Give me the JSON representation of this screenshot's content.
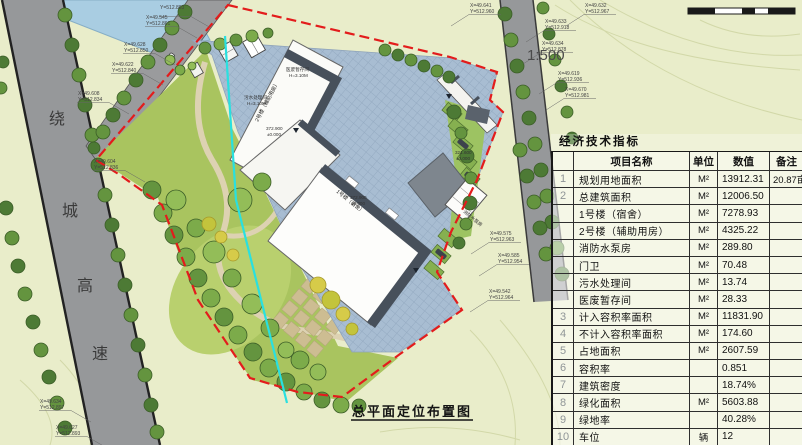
{
  "meta": {
    "scale_label": "1:500",
    "drawing_title": "总平面定位布置图"
  },
  "highway": [
    "绕",
    "城",
    "高",
    "速"
  ],
  "plan_labels": {
    "bld1_name": "1号楼（宿舍）",
    "bld2_name": "2号楼（辅助用房）",
    "sewage_room": "污水处理间",
    "sewage_h": "H=3.10M",
    "medical_room": "医废暂存间",
    "medical_h": "H=3.10M",
    "pump_room": "消防水泵房",
    "pump_elev": "321.600",
    "pump_zero": "±0.000",
    "elev": "372.900",
    "elev_zero": "±0.000"
  },
  "coordinates": [
    {
      "x": 470,
      "y": 2,
      "l1": "X=49.641",
      "l2": "Y=512.960",
      "side": "R"
    },
    {
      "x": 160,
      "y": 4,
      "l1": "Y=512.883",
      "l2": "",
      "side": "L"
    },
    {
      "x": 146,
      "y": 14,
      "l1": "X=49.545",
      "l2": "Y=512.861",
      "side": "L"
    },
    {
      "x": 124,
      "y": 41,
      "l1": "X=49.628",
      "l2": "Y=512.850",
      "side": "L"
    },
    {
      "x": 112,
      "y": 61,
      "l1": "X=49.622",
      "l2": "Y=512.840",
      "side": "L"
    },
    {
      "x": 78,
      "y": 90,
      "l1": "X=49.608",
      "l2": "Y=512.834",
      "side": "L"
    },
    {
      "x": 94,
      "y": 158,
      "l1": "X=49.604",
      "l2": "Y=512.836",
      "side": "L"
    },
    {
      "x": 585,
      "y": 2,
      "l1": "X=49.632",
      "l2": "Y=512.967",
      "side": "R"
    },
    {
      "x": 545,
      "y": 18,
      "l1": "X=49.633",
      "l2": "Y=512.918",
      "side": "R"
    },
    {
      "x": 542,
      "y": 40,
      "l1": "X=49.634",
      "l2": "Y=512.878",
      "side": "R"
    },
    {
      "x": 558,
      "y": 70,
      "l1": "X=49.619",
      "l2": "Y=512.936",
      "side": "R"
    },
    {
      "x": 565,
      "y": 86,
      "l1": "X=49.670",
      "l2": "Y=512.981",
      "side": "R"
    },
    {
      "x": 490,
      "y": 230,
      "l1": "X=49.575",
      "l2": "Y=512.963",
      "side": "R"
    },
    {
      "x": 498,
      "y": 252,
      "l1": "X=49.585",
      "l2": "Y=512.954",
      "side": "R"
    },
    {
      "x": 489,
      "y": 288,
      "l1": "X=49.542",
      "l2": "Y=512.964",
      "side": "R"
    },
    {
      "x": 40,
      "y": 398,
      "l1": "X=49.634",
      "l2": "Y=512.897",
      "side": "L"
    },
    {
      "x": 56,
      "y": 424,
      "l1": "X=49.627",
      "l2": "Y=512.893",
      "side": "L"
    }
  ],
  "table": {
    "title": "经济技术指标",
    "headers": [
      "项目名称",
      "单位",
      "数值",
      "备注"
    ],
    "rows": [
      {
        "no": "1",
        "name": "规划用地面积",
        "unit": "M²",
        "value": "13912.31",
        "remark": "20.87亩"
      },
      {
        "no": "2",
        "name": "总建筑面积",
        "unit": "M²",
        "value": "12006.50",
        "remark": ""
      },
      {
        "no": "",
        "name": "1号楼（宿舍）",
        "unit": "M²",
        "value": "7278.93",
        "remark": ""
      },
      {
        "no": "",
        "name": "2号楼（辅助用房）",
        "unit": "M²",
        "value": "4325.22",
        "remark": ""
      },
      {
        "no": "",
        "name": "消防水泵房",
        "unit": "M²",
        "value": "289.80",
        "remark": ""
      },
      {
        "no": "",
        "name": "门卫",
        "unit": "M²",
        "value": "70.48",
        "remark": ""
      },
      {
        "no": "",
        "name": "污水处理间",
        "unit": "M²",
        "value": "13.74",
        "remark": ""
      },
      {
        "no": "",
        "name": "医废暂存间",
        "unit": "M²",
        "value": "28.33",
        "remark": ""
      },
      {
        "no": "3",
        "name": "计入容积率面积",
        "unit": "M²",
        "value": "11831.90",
        "remark": ""
      },
      {
        "no": "4",
        "name": "不计入容积率面积",
        "unit": "M²",
        "value": "174.60",
        "remark": ""
      },
      {
        "no": "5",
        "name": "占地面积",
        "unit": "M²",
        "value": "2607.59",
        "remark": ""
      },
      {
        "no": "6",
        "name": "容积率",
        "unit": "",
        "value": "0.851",
        "remark": ""
      },
      {
        "no": "7",
        "name": "建筑密度",
        "unit": "",
        "value": "18.74%",
        "remark": ""
      },
      {
        "no": "8",
        "name": "绿化面积",
        "unit": "M²",
        "value": "5603.88",
        "remark": ""
      },
      {
        "no": "9",
        "name": "绿地率",
        "unit": "",
        "value": "40.28%",
        "remark": ""
      },
      {
        "no": "10",
        "name": "车位",
        "unit": "辆",
        "value": "12",
        "remark": ""
      }
    ]
  },
  "colors": {
    "background": "#e9edca",
    "water": "#a9cde2",
    "road": "#96989a",
    "paving": "#a8bdd2",
    "boundary_red": "#e31c1c",
    "survey_cyan": "#29e0e0",
    "roof_dark": "#47505b",
    "garden_green": "#a9c45f"
  }
}
